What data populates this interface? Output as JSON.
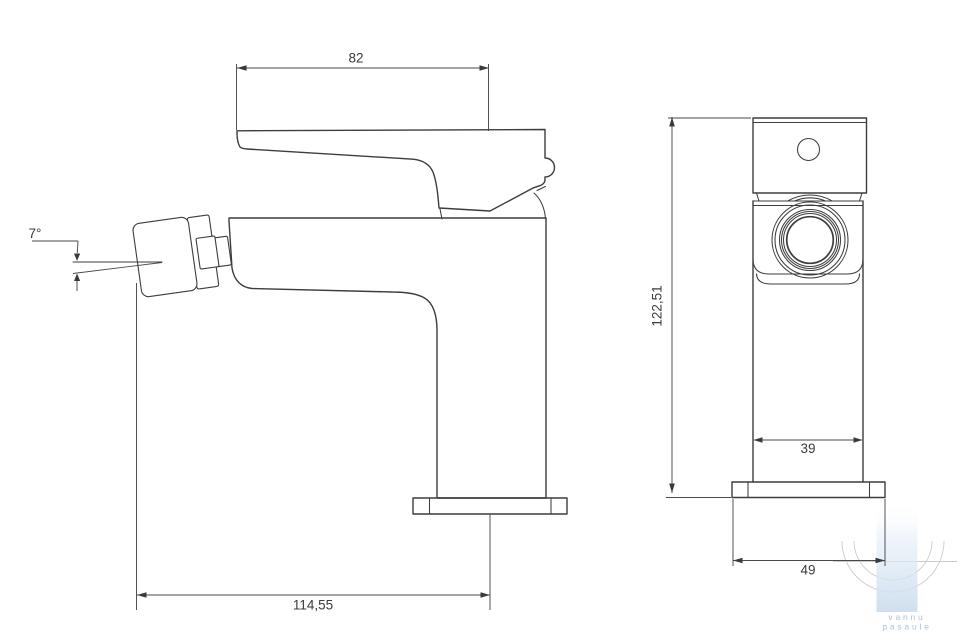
{
  "dimensions": {
    "handle_length": "82",
    "spout_angle": "7°",
    "overall_reach": "114,55",
    "overall_height": "122,51",
    "body_width": "39",
    "base_width": "49"
  },
  "watermark": {
    "line1": "vannu",
    "line2": "pasaule"
  },
  "colors": {
    "outline": "#3d3d3d",
    "dimension": "#4a4a4a",
    "watermark_fill": "#cfdfee",
    "watermark_text": "#aebfd2"
  }
}
